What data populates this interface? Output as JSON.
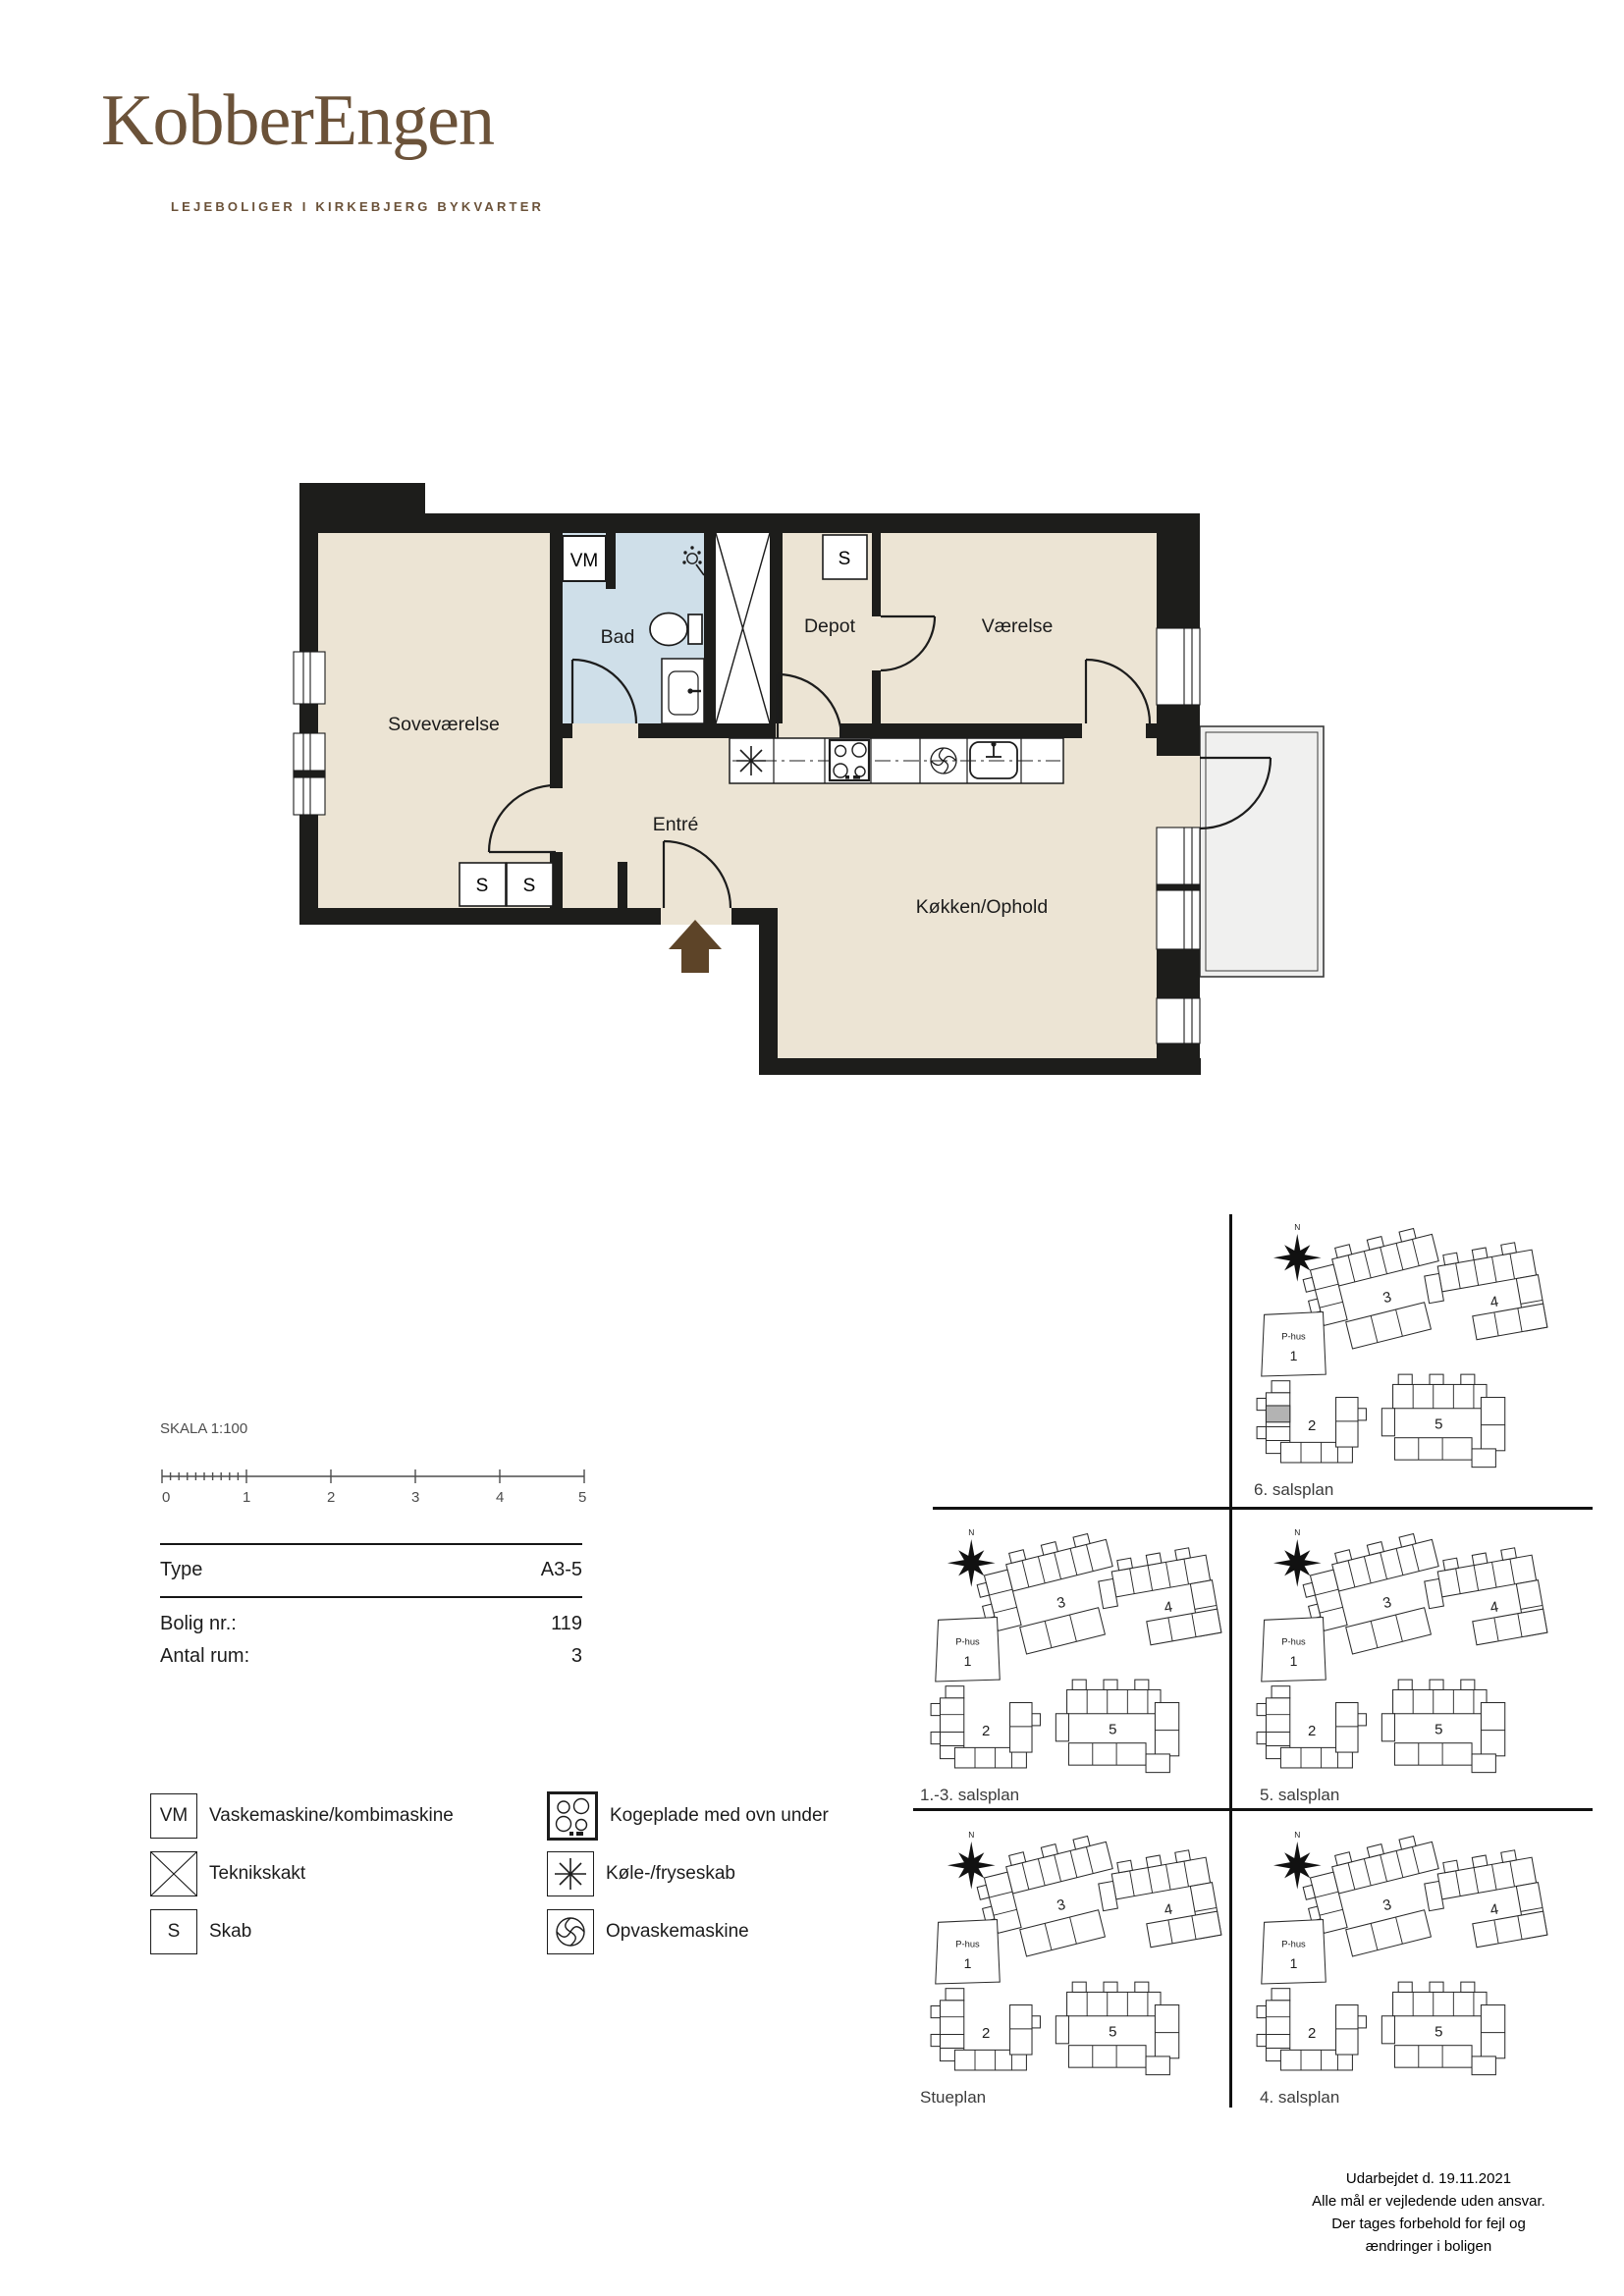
{
  "brand": {
    "name": "KobberEngen",
    "tagline": "LEJEBOLIGER I KIRKEBJERG BYKVARTER"
  },
  "plan": {
    "rooms": {
      "bedroom": "Soveværelse",
      "bath": "Bad",
      "depot": "Depot",
      "room": "Værelse",
      "entry": "Entré",
      "kitchen": "Køkken/Ophold"
    },
    "markers": {
      "vm": "VM",
      "s": "S"
    }
  },
  "scalebar": {
    "title": "SKALA 1:100",
    "ticks": [
      "0",
      "1",
      "2",
      "3",
      "4",
      "5"
    ]
  },
  "info": {
    "rows": [
      {
        "label": "Type",
        "value": "A3-5"
      },
      {
        "label": "Bolig nr.:",
        "value": "119"
      },
      {
        "label": "Antal rum:",
        "value": "3"
      }
    ]
  },
  "legend": {
    "items_left": [
      {
        "icon": "vm-box",
        "label": "Vaskemaskine/kombimaskine"
      },
      {
        "icon": "shaft",
        "label": "Teknikskakt"
      },
      {
        "icon": "s-box",
        "label": "Skab"
      }
    ],
    "items_right": [
      {
        "icon": "stove",
        "label": "Kogeplade med ovn under"
      },
      {
        "icon": "freezer",
        "label": "Køle-/fryseskab"
      },
      {
        "icon": "dishwasher",
        "label": "Opvaskemaskine"
      }
    ]
  },
  "siteplans": {
    "north": "N",
    "phus_label": "P-hus",
    "phus_number": "1",
    "buildings": {
      "b2": "2",
      "b3": "3",
      "b4": "4",
      "b5": "5"
    },
    "panels": [
      {
        "label": "6. salsplan",
        "highlight": true
      },
      {
        "label": "1.-3. salsplan",
        "highlight": false
      },
      {
        "label": "5. salsplan",
        "highlight": false
      },
      {
        "label": "Stueplan",
        "highlight": false
      },
      {
        "label": "4. salsplan",
        "highlight": false
      }
    ]
  },
  "footer": {
    "lines": [
      "Udarbejdet d. 19.11.2021",
      "Alle mål er vejledende uden ansvar.",
      "Der tages forbehold for fejl og",
      "ændringer i boligen"
    ]
  },
  "colors": {
    "brand": "#6b5239",
    "floor": "#ece4d4",
    "bath": "#cfdfe9",
    "wall": "#1d1d1b",
    "balcony": "#f0f0ef",
    "arrow": "#5d4428",
    "highlight": "#b3b3b3"
  }
}
